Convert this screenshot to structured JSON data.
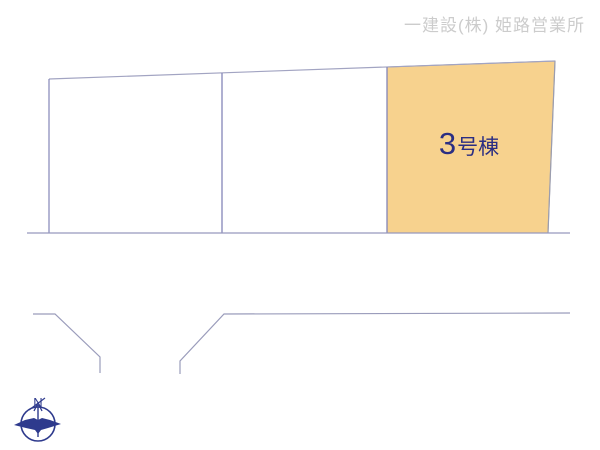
{
  "header": {
    "company": "一建設(株) 姫路営業所"
  },
  "plan": {
    "plots": [
      {
        "id": "plot-1",
        "label": "",
        "highlighted": false
      },
      {
        "id": "plot-2",
        "label": "",
        "highlighted": false
      },
      {
        "id": "plot-3",
        "label": "3号棟",
        "label_number": "3",
        "label_suffix": "号棟",
        "highlighted": true
      }
    ],
    "highlight_color": "#f7d28e",
    "line_color": "#9799bd",
    "divider_color": "#8486b8",
    "label_color": "#2b2e83"
  },
  "compass": {
    "north_label": "N",
    "color": "#2e3a8d"
  }
}
